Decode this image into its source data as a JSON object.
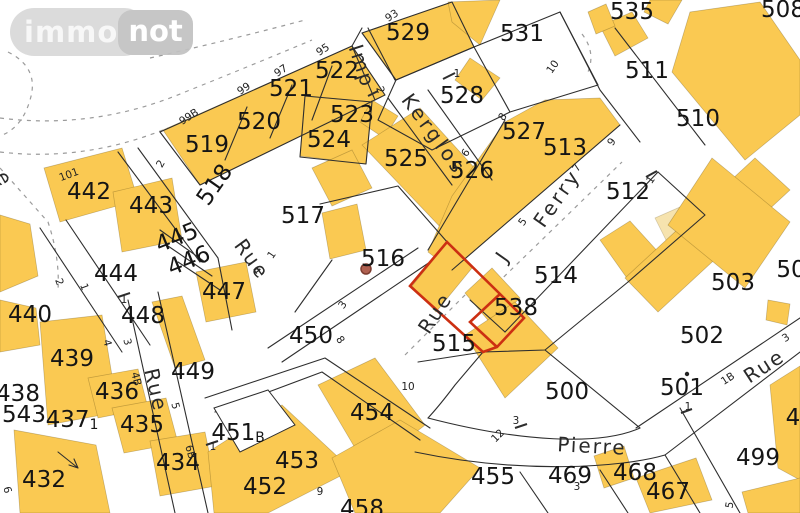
{
  "logo": {
    "immo": "immo",
    "not": "not"
  },
  "map": {
    "selected_parcel": "538",
    "colors": {
      "building": "#fac952",
      "building_light": "#f6e3ae",
      "line": "#2e2e2e",
      "dashed": "#9b9b9b",
      "selection": "#cc2f12",
      "label": "#151515",
      "marker_dot": "#b06050"
    },
    "parcels": [
      {
        "t": "432",
        "x": 44,
        "y": 480
      },
      {
        "t": "434",
        "x": 178,
        "y": 463
      },
      {
        "t": "435",
        "x": 142,
        "y": 425
      },
      {
        "t": "436",
        "x": 117,
        "y": 392
      },
      {
        "t": "437",
        "x": 72,
        "y": 420,
        "sub": "1"
      },
      {
        "t": "438",
        "x": 18,
        "y": 394
      },
      {
        "t": "439",
        "x": 72,
        "y": 359
      },
      {
        "t": "440",
        "x": 30,
        "y": 315
      },
      {
        "t": "442",
        "x": 89,
        "y": 192
      },
      {
        "t": "443",
        "x": 151,
        "y": 206
      },
      {
        "t": "444",
        "x": 116,
        "y": 274
      },
      {
        "t": "445",
        "x": 177,
        "y": 238,
        "r": -22
      },
      {
        "t": "446",
        "x": 189,
        "y": 261,
        "r": -22
      },
      {
        "t": "447",
        "x": 224,
        "y": 292
      },
      {
        "t": "448",
        "x": 143,
        "y": 316
      },
      {
        "t": "449",
        "x": 193,
        "y": 372
      },
      {
        "t": "450",
        "x": 311,
        "y": 336
      },
      {
        "t": "451",
        "x": 238,
        "y": 433,
        "sub": "B"
      },
      {
        "t": "452",
        "x": 265,
        "y": 487
      },
      {
        "t": "453",
        "x": 297,
        "y": 461
      },
      {
        "t": "454",
        "x": 372,
        "y": 413
      },
      {
        "t": "455",
        "x": 493,
        "y": 477
      },
      {
        "t": "458",
        "x": 362,
        "y": 509
      },
      {
        "t": "467",
        "x": 668,
        "y": 492
      },
      {
        "t": "468",
        "x": 635,
        "y": 473
      },
      {
        "t": "469",
        "x": 570,
        "y": 476
      },
      {
        "t": "499",
        "x": 758,
        "y": 458
      },
      {
        "t": "500",
        "x": 567,
        "y": 392
      },
      {
        "t": "501",
        "x": 682,
        "y": 388
      },
      {
        "t": "502",
        "x": 702,
        "y": 336
      },
      {
        "t": "503",
        "x": 733,
        "y": 283
      },
      {
        "t": "50",
        "x": 791,
        "y": 270
      },
      {
        "t": "508",
        "x": 783,
        "y": 10
      },
      {
        "t": "510",
        "x": 698,
        "y": 119
      },
      {
        "t": "511",
        "x": 647,
        "y": 71
      },
      {
        "t": "512",
        "x": 628,
        "y": 192
      },
      {
        "t": "513",
        "x": 565,
        "y": 148
      },
      {
        "t": "514",
        "x": 556,
        "y": 276
      },
      {
        "t": "515",
        "x": 454,
        "y": 344
      },
      {
        "t": "516",
        "x": 383,
        "y": 259
      },
      {
        "t": "517",
        "x": 303,
        "y": 216
      },
      {
        "t": "518",
        "x": 215,
        "y": 185,
        "r": -55
      },
      {
        "t": "519",
        "x": 207,
        "y": 145
      },
      {
        "t": "520",
        "x": 259,
        "y": 122
      },
      {
        "t": "521",
        "x": 291,
        "y": 89
      },
      {
        "t": "522",
        "x": 337,
        "y": 71
      },
      {
        "t": "523",
        "x": 352,
        "y": 115
      },
      {
        "t": "524",
        "x": 329,
        "y": 140
      },
      {
        "t": "525",
        "x": 406,
        "y": 159
      },
      {
        "t": "526",
        "x": 472,
        "y": 171
      },
      {
        "t": "527",
        "x": 524,
        "y": 132
      },
      {
        "t": "528",
        "x": 462,
        "y": 96
      },
      {
        "t": "529",
        "x": 408,
        "y": 33
      },
      {
        "t": "531",
        "x": 522,
        "y": 34
      },
      {
        "t": "535",
        "x": 632,
        "y": 12
      },
      {
        "t": "538",
        "x": 516,
        "y": 308
      },
      {
        "t": "543",
        "x": 24,
        "y": 415
      },
      {
        "t": "4",
        "x": 793,
        "y": 418
      }
    ],
    "streets": [
      {
        "t": "Imp",
        "x": 362,
        "y": 66,
        "r": 72,
        "ls": 2
      },
      {
        "t": "Kerglos",
        "x": 434,
        "y": 134,
        "r": 54,
        "ls": 3
      },
      {
        "t": "J",
        "x": 502,
        "y": 257,
        "r": -55
      },
      {
        "t": "Ferry",
        "x": 557,
        "y": 198,
        "r": -55,
        "ls": 3
      },
      {
        "t": "Rue",
        "x": 252,
        "y": 259,
        "r": 54,
        "ls": 2
      },
      {
        "t": "Rue",
        "x": 435,
        "y": 313,
        "r": -57,
        "ls": 2
      },
      {
        "t": "Rue",
        "x": 156,
        "y": 390,
        "r": 77,
        "ls": 2
      },
      {
        "t": "Pierre",
        "x": 592,
        "y": 446,
        "r": 3,
        "ls": 2
      },
      {
        "t": "Rue",
        "x": 764,
        "y": 366,
        "r": -33,
        "ls": 2
      },
      {
        "t": "e",
        "x": 4,
        "y": 178,
        "r": 60
      }
    ],
    "house_numbers": [
      {
        "t": "93",
        "x": 392,
        "y": 16,
        "r": -33
      },
      {
        "t": "95",
        "x": 323,
        "y": 50,
        "r": -33
      },
      {
        "t": "97",
        "x": 281,
        "y": 71,
        "r": -33
      },
      {
        "t": "99",
        "x": 244,
        "y": 89,
        "r": -33
      },
      {
        "t": "99B",
        "x": 189,
        "y": 117,
        "r": -33
      },
      {
        "t": "101",
        "x": 69,
        "y": 175,
        "r": -20
      },
      {
        "t": "2",
        "x": 380,
        "y": 90,
        "r": 70
      },
      {
        "t": "2",
        "x": 161,
        "y": 164,
        "r": -60
      },
      {
        "t": "1",
        "x": 457,
        "y": 74
      },
      {
        "t": "10",
        "x": 553,
        "y": 67,
        "r": -55
      },
      {
        "t": "8",
        "x": 503,
        "y": 117,
        "r": -55
      },
      {
        "t": "6",
        "x": 466,
        "y": 153,
        "r": -55
      },
      {
        "t": "7",
        "x": 577,
        "y": 168,
        "r": -55
      },
      {
        "t": "9",
        "x": 612,
        "y": 142,
        "r": -55
      },
      {
        "t": "5",
        "x": 523,
        "y": 222,
        "r": -55
      },
      {
        "t": "1",
        "x": 651,
        "y": 180,
        "r": -55
      },
      {
        "t": "1",
        "x": 272,
        "y": 255,
        "r": -55
      },
      {
        "t": "4",
        "x": 256,
        "y": 271,
        "r": 55
      },
      {
        "t": "3",
        "x": 343,
        "y": 305,
        "r": -55
      },
      {
        "t": "8",
        "x": 340,
        "y": 340,
        "r": 55
      },
      {
        "t": "1",
        "x": 124,
        "y": 300
      },
      {
        "t": "2",
        "x": 59,
        "y": 282,
        "r": 70
      },
      {
        "t": "1",
        "x": 84,
        "y": 287,
        "r": 70
      },
      {
        "t": "4",
        "x": 107,
        "y": 343,
        "r": 75
      },
      {
        "t": "3",
        "x": 127,
        "y": 342,
        "r": 75
      },
      {
        "t": "4B",
        "x": 136,
        "y": 379,
        "r": 75
      },
      {
        "t": "5",
        "x": 175,
        "y": 406,
        "r": 75
      },
      {
        "t": "6B",
        "x": 190,
        "y": 452,
        "r": 75
      },
      {
        "t": "1",
        "x": 213,
        "y": 447
      },
      {
        "t": "6",
        "x": 7,
        "y": 490,
        "r": 75
      },
      {
        "t": "10",
        "x": 408,
        "y": 387
      },
      {
        "t": "9",
        "x": 320,
        "y": 492
      },
      {
        "t": "3",
        "x": 516,
        "y": 421
      },
      {
        "t": "12",
        "x": 498,
        "y": 436,
        "r": -45
      },
      {
        "t": "3",
        "x": 577,
        "y": 487
      },
      {
        "t": "3",
        "x": 786,
        "y": 338,
        "r": -33
      },
      {
        "t": "1B",
        "x": 728,
        "y": 379,
        "r": -33
      },
      {
        "t": "1",
        "x": 688,
        "y": 407
      },
      {
        "t": "5",
        "x": 730,
        "y": 505,
        "r": -80
      }
    ]
  }
}
